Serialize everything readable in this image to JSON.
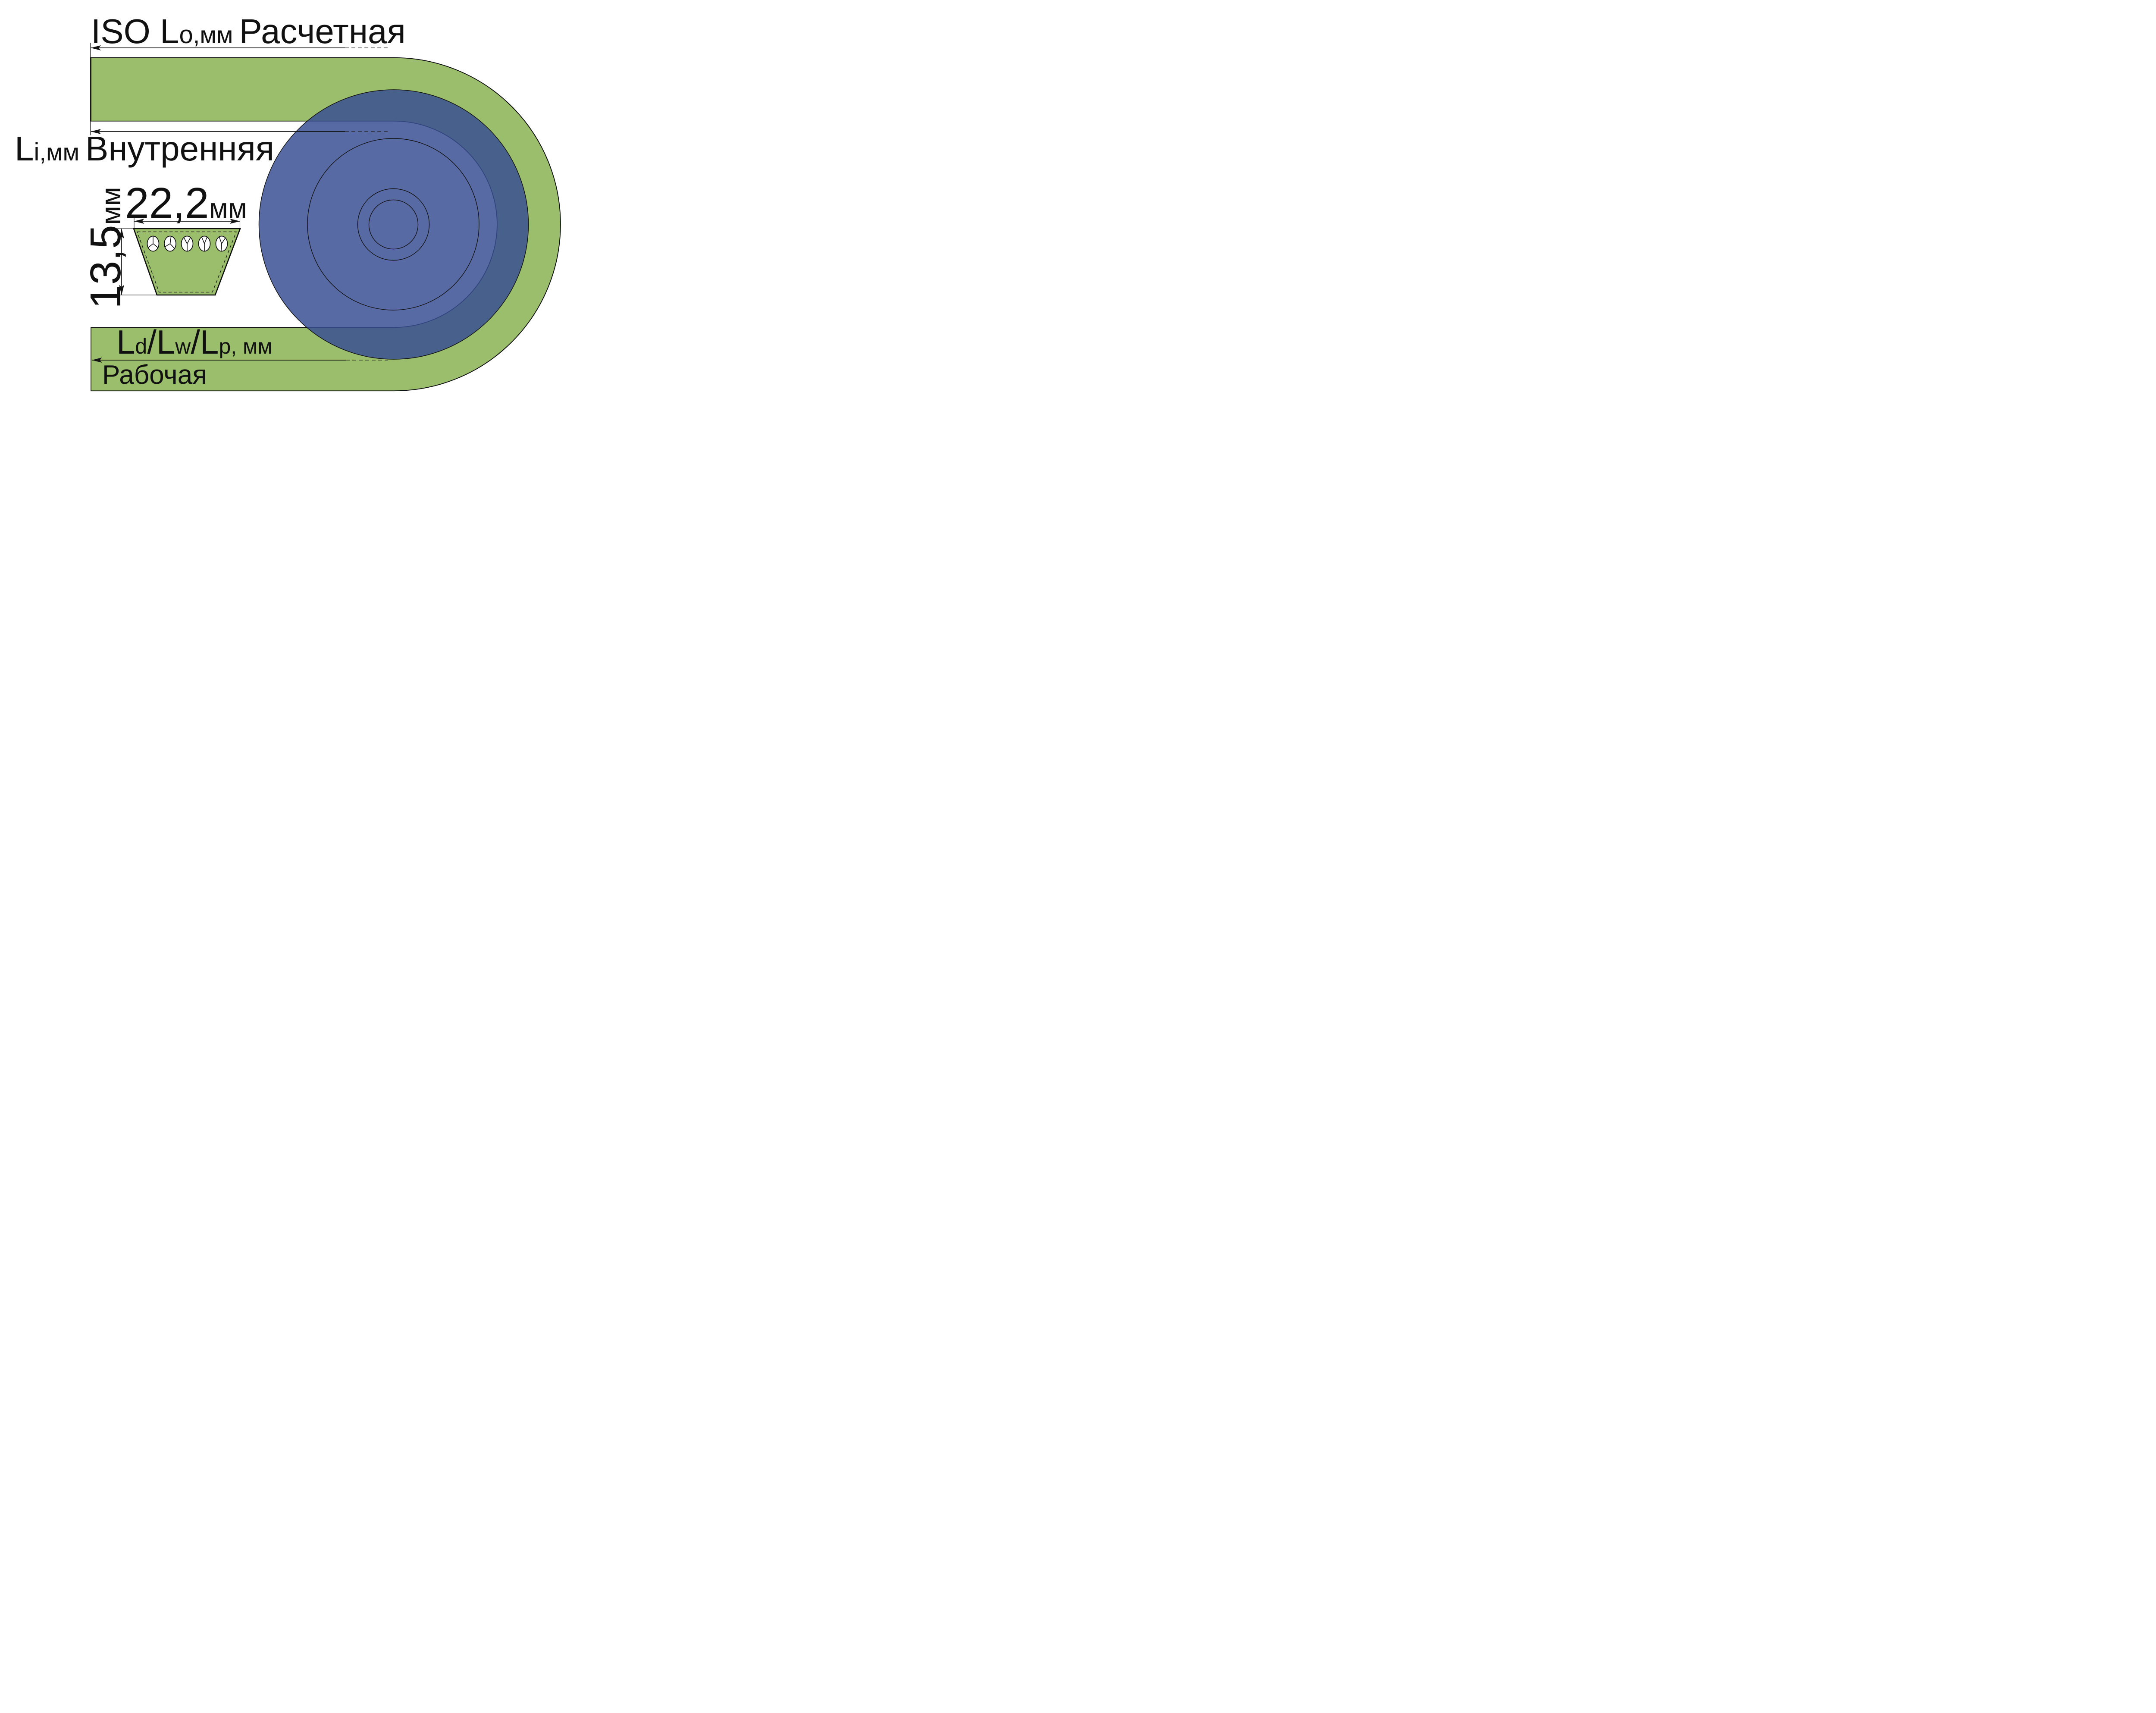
{
  "diagram_title": "V-belt length and cross-section dimensions diagram",
  "labels": {
    "outer_length": {
      "symbol_main": "ISO L",
      "symbol_sub": "o",
      "unit": ",мм",
      "caption": "Расчетная"
    },
    "inner_length": {
      "symbol_main": "L",
      "symbol_sub": "i",
      "unit": ",мм",
      "caption": "Внутренняя"
    },
    "belt_width": {
      "value": "22,2",
      "unit": "мм"
    },
    "belt_height": {
      "value": "13,5",
      "unit": "мм"
    },
    "pitch_length": {
      "seg1": "L",
      "sub1": "d",
      "sep1": "/",
      "seg2": "L",
      "sub2": "w",
      "sep2": "/",
      "seg3": "L",
      "sub3": "p",
      "unit": ", мм"
    },
    "working_caption": "Рабочая"
  },
  "cross_section": {
    "cord_count": 5
  },
  "colors": {
    "belt_green": "#9BBE6C",
    "pulley_blue_fill": "rgb(56,78,147)",
    "outline_black": "#141414"
  }
}
